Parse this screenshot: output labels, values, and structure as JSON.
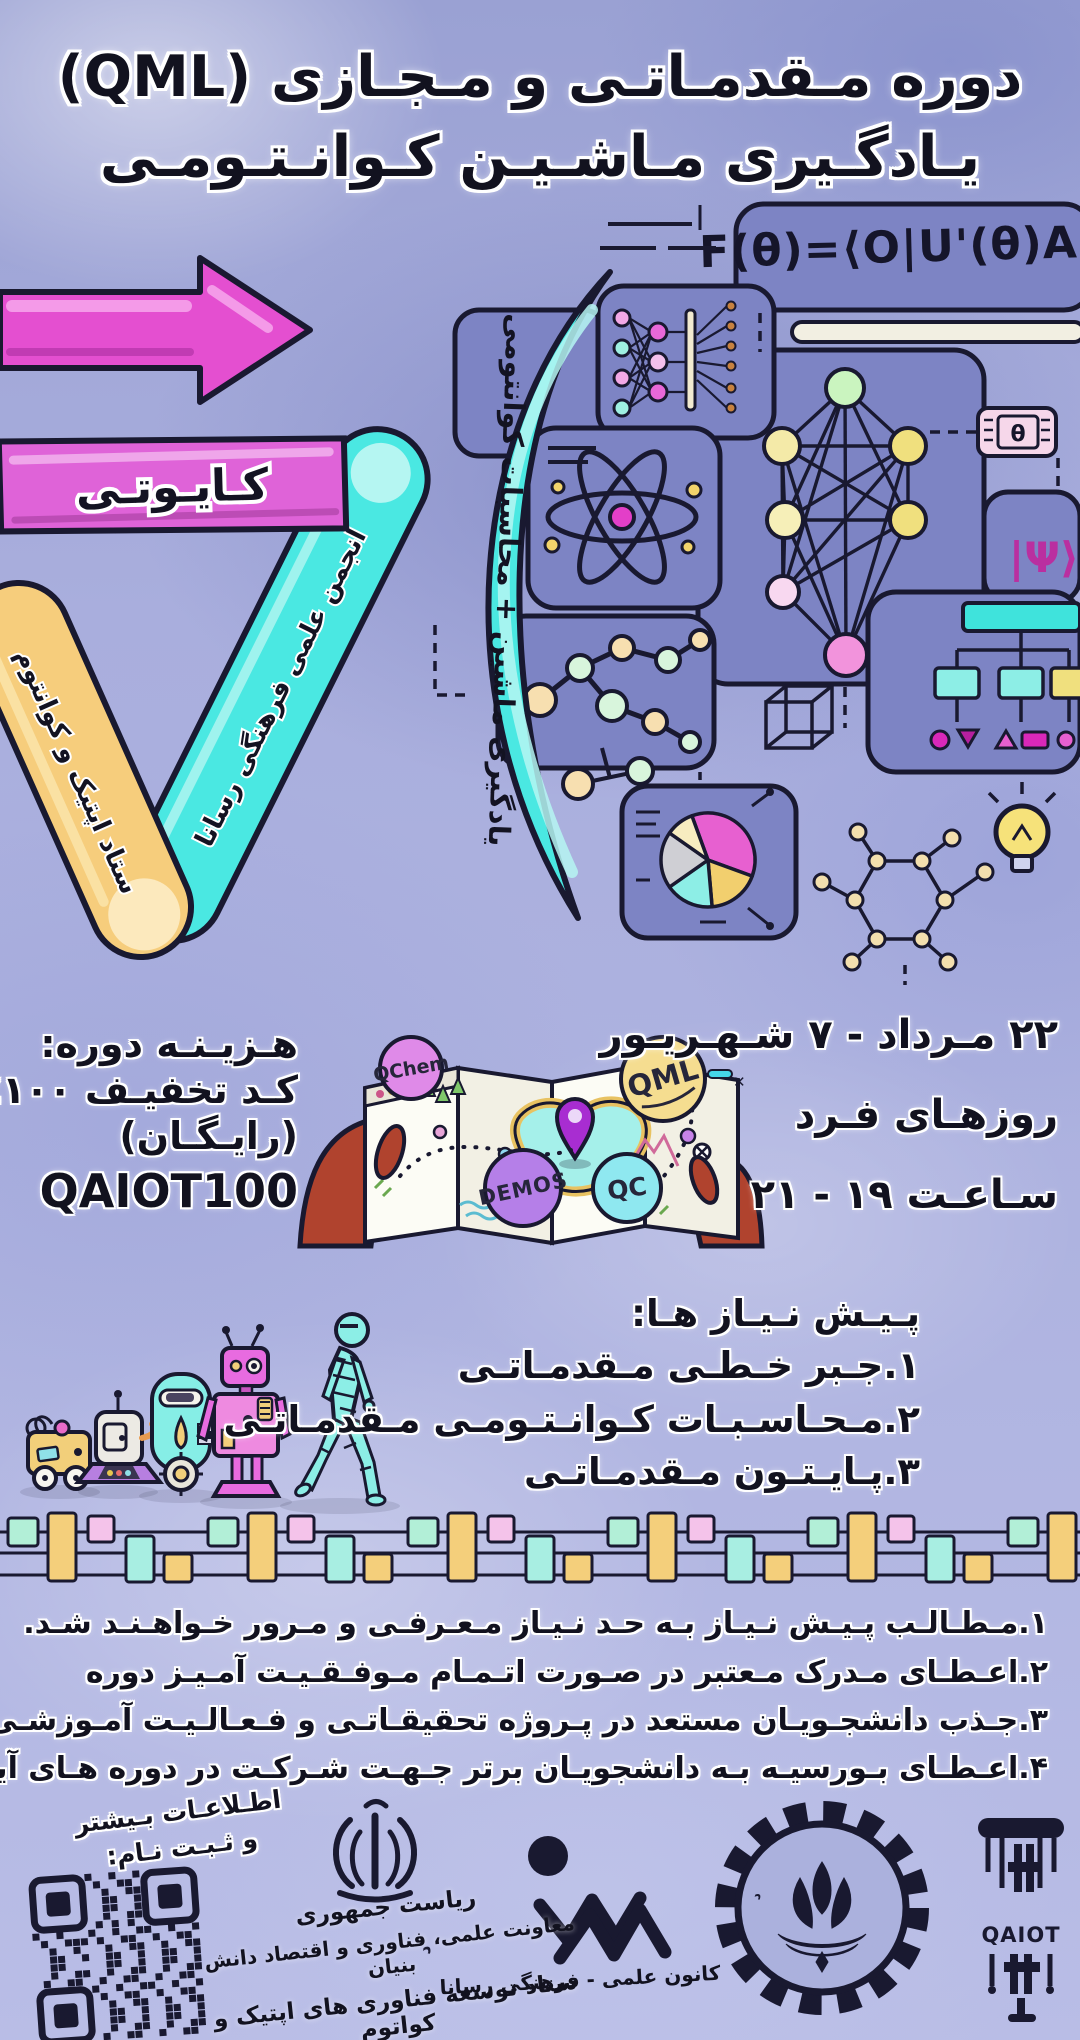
{
  "title": {
    "line1": "دوره مـقدمـاتـی و مـجـازی (QML)",
    "line2": "یـادگـیری مـاشـیـن کـوانـتـومـی"
  },
  "hero": {
    "formula": "F(θ)=⟨O|U'(θ)A",
    "qaiot_band": "کـایـوتـی",
    "optics_band": "ستاد اپتیک و کوانتوم",
    "rasana_band": "انجمن علمی فرهنگی رسانا",
    "paren_text": "یادگیری ماشین + محاسبات کوانتومی",
    "psi": "|Ψ⟩",
    "theta": "θ"
  },
  "map": {
    "qchem": "QChem",
    "demos": "DEMOS",
    "qml": "QML",
    "qc": "QC",
    "close": "✕"
  },
  "cost": {
    "heading": "هـزیـنـه دوره:",
    "discount": "کـد تخفیـف ۱۰۰٪",
    "free": "(رایـگـان)",
    "code": "QAIOT100"
  },
  "schedule": {
    "dates": "۲۲ مـرداد - ۷ شـهـریـور",
    "days": "روزهـای فـرد",
    "time": "سـاعـت ۱۹ - ۲۱"
  },
  "prerequisites": {
    "heading": "پـیـش نـیـاز هـا:",
    "items": [
      "۱.جـبر خـطـی مـقدمـاتـی",
      "۲.مـحـاسـبـات کـوانـتـومـی مـقدمـاتـی",
      "۳.پـایـتـون مـقدمـاتـی"
    ]
  },
  "notes": [
    "۱.مـطـالـب پـیـش نـیـاز بـه حـد نـیـاز مـعـرفـی و مـرور خـواهـنـد شـد.",
    "۲.اعـطـای مـدرک مـعتبر در صـورت اتـمـام مـوفـقـیـت آمـیـز دوره",
    "۳.جـذب دانشجـویـان مستعد در پـروژه تحقیقـاتـی و فـعـالـیـت آمـوزشـی",
    "۴.اعـطـای بـورسیـه بـه دانشجویـان برتر جـهـت شـرکـت در دوره هـای آیـنده"
  ],
  "footer": {
    "register_line1": "اطـلاعـات بـیشتر",
    "register_line2": "و ثـبـت نـام:",
    "gov_line1": "ریاست جمهوری",
    "gov_line2": "معاونت علمی، فناوری و اقتصاد دانش بنیان",
    "gov_line3": "ستاد توسعه فناوری های اپتیک و کواتوم",
    "rasana_arc": "دانشجویان دانشکده مهندسی برق",
    "rasana_label": "کانون علمی - فرهنگی رسانا",
    "sharif_arc": "دانشگاه صنعتی شریف",
    "qaiot": "QAIOT"
  },
  "colors": {
    "accent_pink": "#e44fd0",
    "accent_cyan": "#4ae8e2",
    "accent_yellow": "#f6cd7c",
    "panel": "#7d84c4",
    "ink": "#191930"
  },
  "circuit": {
    "colors": [
      "#b2efd7",
      "#f4cf7b",
      "#f4c3ea",
      "#a8eee2",
      "#f4cf7b"
    ]
  }
}
